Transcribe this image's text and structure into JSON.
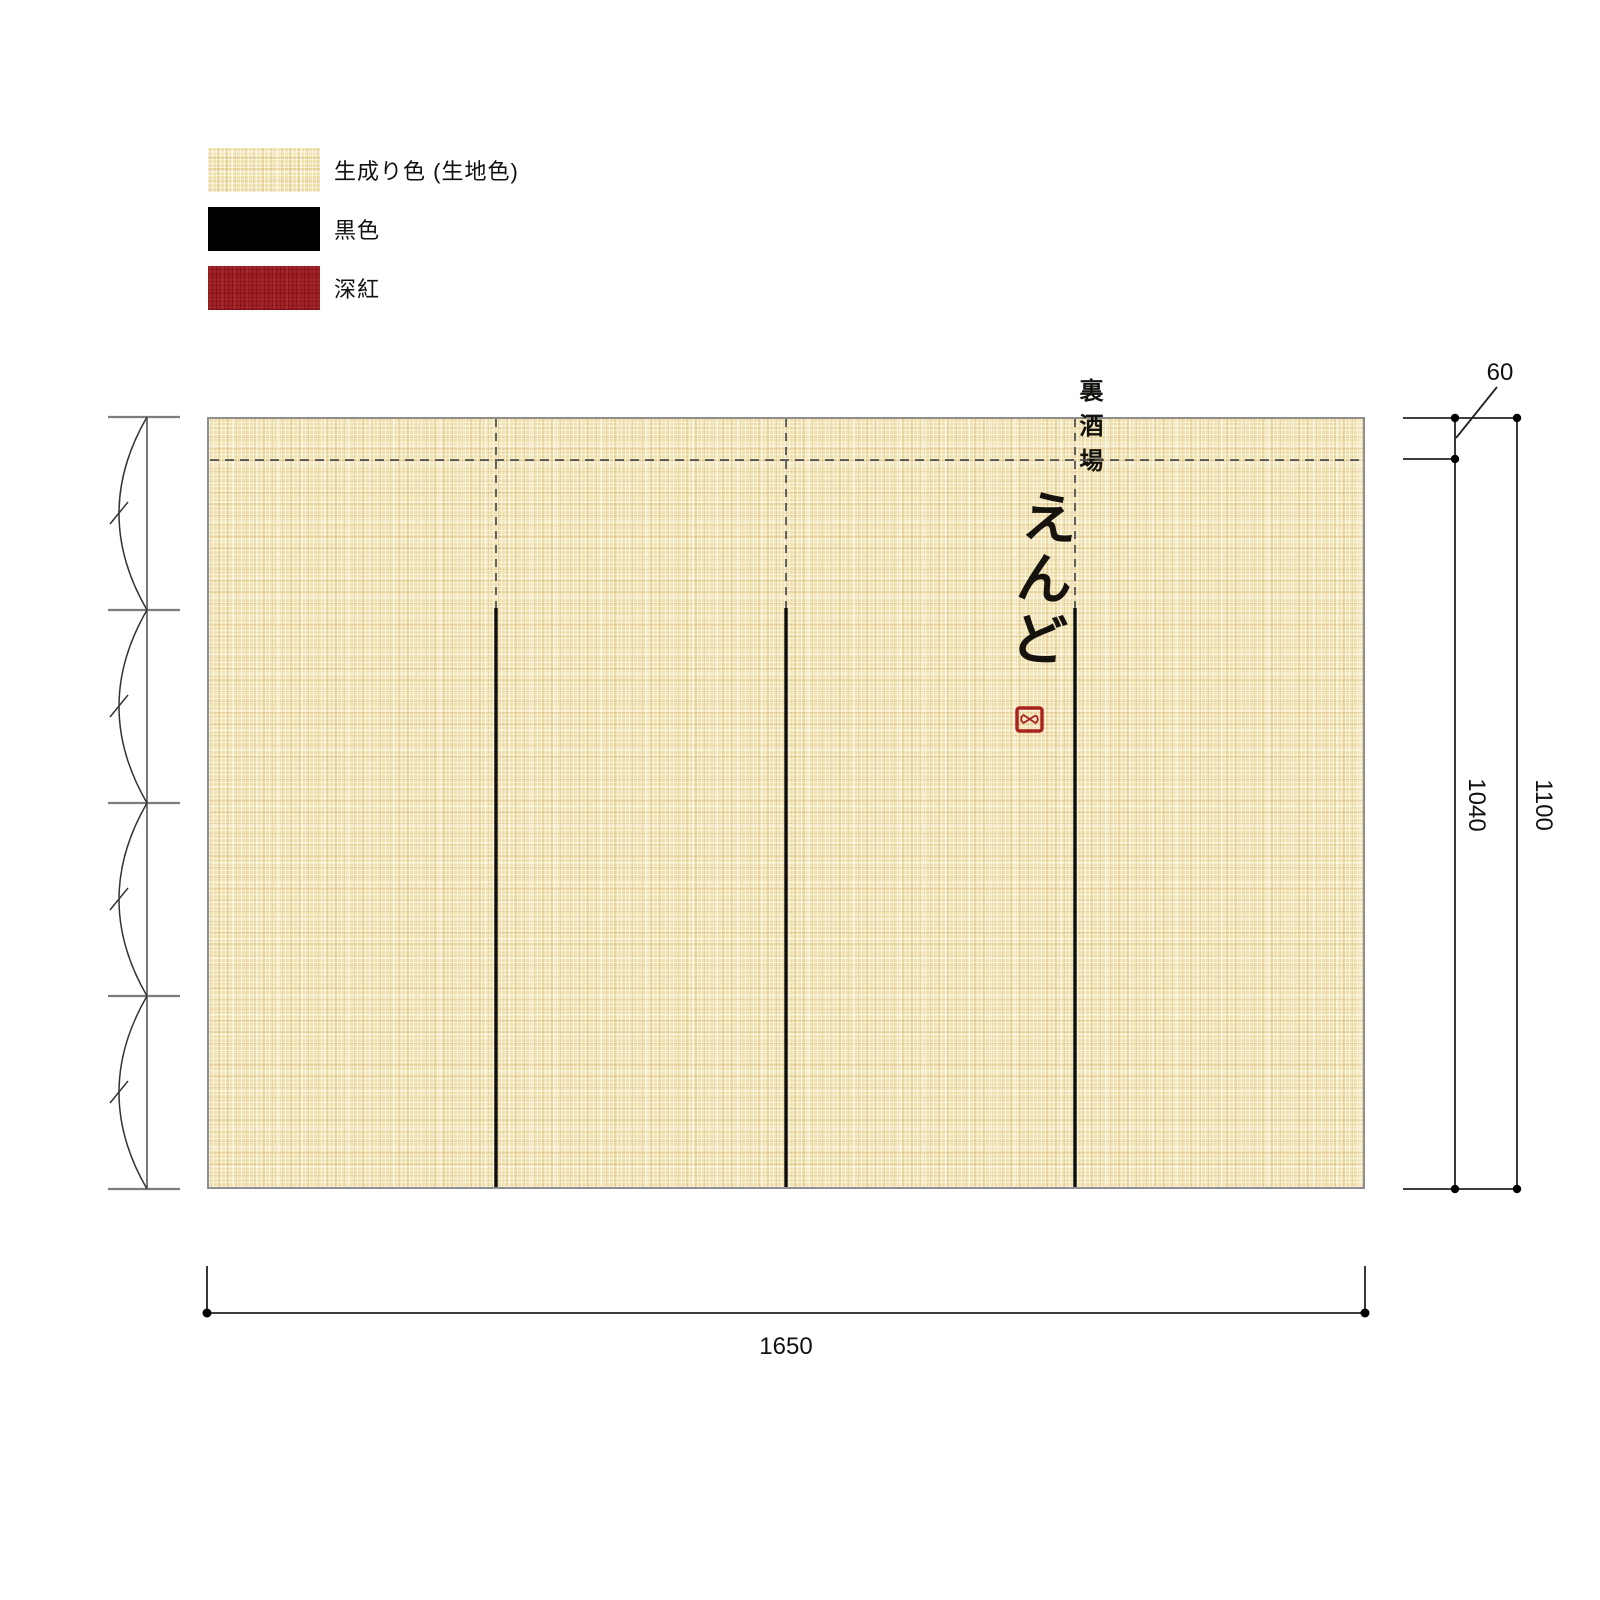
{
  "legend": {
    "items": [
      {
        "label": "生成り色 (生地色)",
        "color": "#efe0ac",
        "swatch": "fabric-weave"
      },
      {
        "label": "黒色",
        "color": "#000000",
        "swatch": "solid-black"
      },
      {
        "label": "深紅",
        "color": "#a42127",
        "swatch": "crimson-weave"
      }
    ]
  },
  "noren": {
    "shop_type_vertical_text": "裏酒場",
    "shop_name_vertical_text": "えんど",
    "seal_icon": "red-seal-stamp",
    "panel_count": 4
  },
  "dimensions": {
    "pocket_height": "60",
    "print_height": "1040",
    "total_height": "1100",
    "total_width": "1650"
  },
  "colors": {
    "fabric_base": "#efe0ac",
    "black_ink": "#000000",
    "deep_crimson": "#a42127",
    "fabric_border": "#8e8e8e"
  }
}
